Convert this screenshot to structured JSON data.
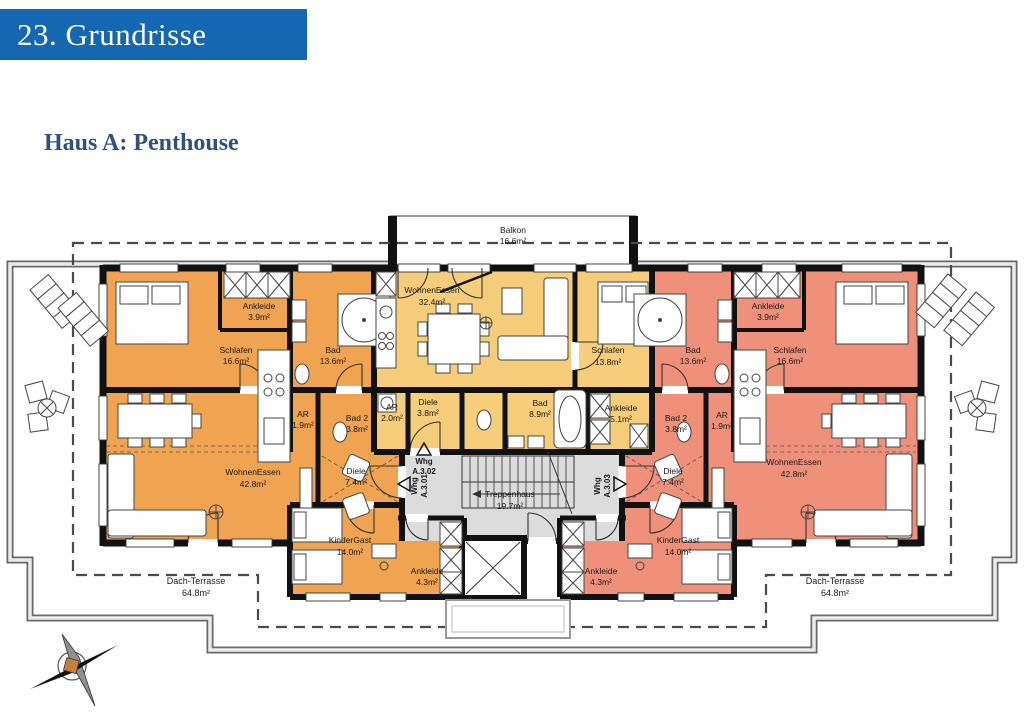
{
  "page": {
    "header_title": "23. Grundrisse",
    "subtitle": "Haus A: Penthouse"
  },
  "colors": {
    "header_bar": "#1667B1",
    "subtitle_text": "#31517C",
    "unit_a301": "#F0A351",
    "unit_a302": "#F6CE7B",
    "unit_a303": "#EF907A",
    "stairwell": "#DCDCDC"
  },
  "floorplan": {
    "balcony": {
      "name": "Balkon",
      "area": "16.6m²"
    },
    "stairwell": {
      "name": "Treppenhaus",
      "area": "19.7m²"
    },
    "terrace_left": {
      "name": "Dach-Terrasse",
      "area": "64.8m²"
    },
    "terrace_right": {
      "name": "Dach-Terrasse",
      "area": "64.8m²"
    },
    "entries": {
      "a301": {
        "line1": "Whg",
        "line2": "A.3.01"
      },
      "a302": {
        "line1": "Whg",
        "line2": "A.3.02"
      },
      "a303": {
        "line1": "Whg",
        "line2": "A.3.03"
      }
    },
    "left": {
      "rooms": {
        "schlafen": {
          "name": "Schlafen",
          "area": "16.6m²"
        },
        "ankleide": {
          "name": "Ankleide",
          "area": "3.9m²"
        },
        "bad": {
          "name": "Bad",
          "area": "13.6m²"
        },
        "ar": {
          "name": "AR",
          "area": "1.9m²"
        },
        "bad2": {
          "name": "Bad 2",
          "area": "3.8m²"
        },
        "wohnen": {
          "name": "WohnenEssen",
          "area": "42.8m²"
        },
        "diele": {
          "name": "Diele",
          "area": "7.4m²"
        },
        "kindergast": {
          "name": "KinderGast",
          "area": "14.0m²"
        },
        "ankleide2": {
          "name": "Ankleide",
          "area": "4.3m²"
        }
      }
    },
    "center": {
      "rooms": {
        "wohnen": {
          "name": "WohnenEssen",
          "area": "32.4m²"
        },
        "schlafen": {
          "name": "Schlafen",
          "area": "13.8m²"
        },
        "bad": {
          "name": "Bad",
          "area": "8.9m²"
        },
        "ankleide": {
          "name": "Ankleide",
          "area": "5.1m²"
        },
        "diele": {
          "name": "Diele",
          "area": "3.8m²"
        },
        "ar": {
          "name": "AR",
          "area": "2.0m²"
        }
      }
    },
    "right": {
      "rooms": {
        "schlafen": {
          "name": "Schlafen",
          "area": "16.6m²"
        },
        "ankleide": {
          "name": "Ankleide",
          "area": "3.9m²"
        },
        "bad": {
          "name": "Bad",
          "area": "13.6m²"
        },
        "ar": {
          "name": "AR",
          "area": "1.9m²"
        },
        "bad2": {
          "name": "Bad 2",
          "area": "3.8m²"
        },
        "wohnen": {
          "name": "WohnenEssen",
          "area": "42.8m²"
        },
        "diele": {
          "name": "Diele",
          "area": "7.4m²"
        },
        "kindergast": {
          "name": "KinderGast",
          "area": "14.0m²"
        },
        "ankleide2": {
          "name": "Ankleide",
          "area": "4.3m²"
        }
      }
    }
  }
}
